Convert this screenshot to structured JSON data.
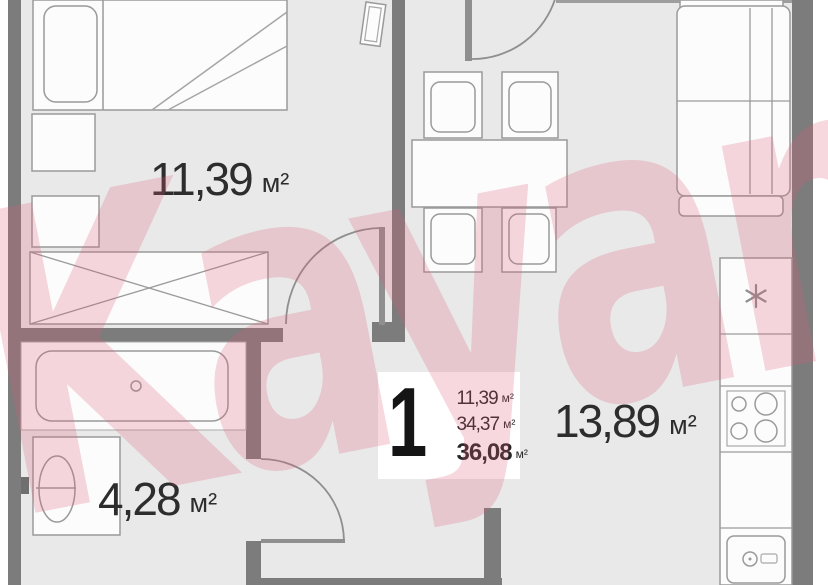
{
  "watermark": {
    "text": "Kayan",
    "color": "#d95c73",
    "opacity": 0.24
  },
  "plan": {
    "type": "apartment-floor-plan",
    "info_box": {
      "rooms_badge": "1",
      "rows": [
        {
          "value": "11,39",
          "unit": "м²"
        },
        {
          "value": "34,37",
          "unit": "м²"
        },
        {
          "value": "36,08",
          "unit": "м²",
          "bold": true
        }
      ]
    },
    "room_labels": [
      {
        "room": "bedroom",
        "value": "11,39",
        "unit": "м²"
      },
      {
        "room": "bathroom",
        "value": "4,28",
        "unit": "м²"
      },
      {
        "room": "kitchen-living",
        "value": "13,89",
        "unit": "м²"
      }
    ],
    "colors": {
      "floor": "#e9e9e9",
      "walls": "#7c7c7c",
      "furniture_outline": "#9a9a9a",
      "label_text": "#2d2d2d",
      "watermark_pink": "#d95c73"
    },
    "furniture_icons": [
      "bed",
      "pillow",
      "nightstand",
      "wardrobe",
      "window-leaf",
      "bathtub",
      "toilet",
      "dining-table",
      "dining-chair",
      "sofa",
      "fridge-freezer-star",
      "stove-burners",
      "kitchen-sink",
      "door-arc"
    ]
  }
}
